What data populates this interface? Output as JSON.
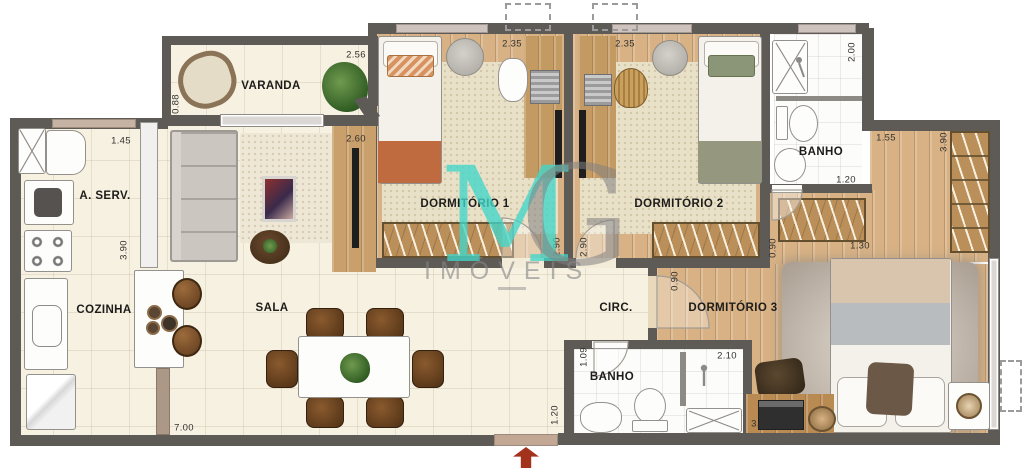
{
  "rooms": {
    "varanda": "VARANDA",
    "area_servico": "A. SERV.",
    "cozinha": "COZINHA",
    "sala": "SALA",
    "dormitorio1": "DORMITÓRIO 1",
    "dormitorio2": "DORMITÓRIO 2",
    "dormitorio3": "DORMITÓRIO 3",
    "banho_suite": "BANHO",
    "banho_social": "BANHO",
    "circulacao": "CIRC."
  },
  "dimensions": [
    "2.56",
    "0.88",
    "1.45",
    "3.90",
    "2.60",
    "2.35",
    "2.35",
    "2.90",
    "2.90",
    "2.00",
    "1.20",
    "1.55",
    "3.90",
    "1.30",
    "0.90",
    "0.90",
    "1.09",
    "2.10",
    "3.15",
    "1.20",
    "7.00"
  ],
  "watermark": {
    "letter_m": "M",
    "letter_g": "G",
    "name": "IMÓVEIS"
  },
  "colors": {
    "wall": "#5e5a56",
    "floor_tile": "#f7f1e1",
    "wood": "#d8b285",
    "carpet": "#e9e0c8",
    "watermark_teal": "#41d6c9",
    "watermark_gray": "#8a8a8a",
    "arrow_red": "#a3321c"
  }
}
